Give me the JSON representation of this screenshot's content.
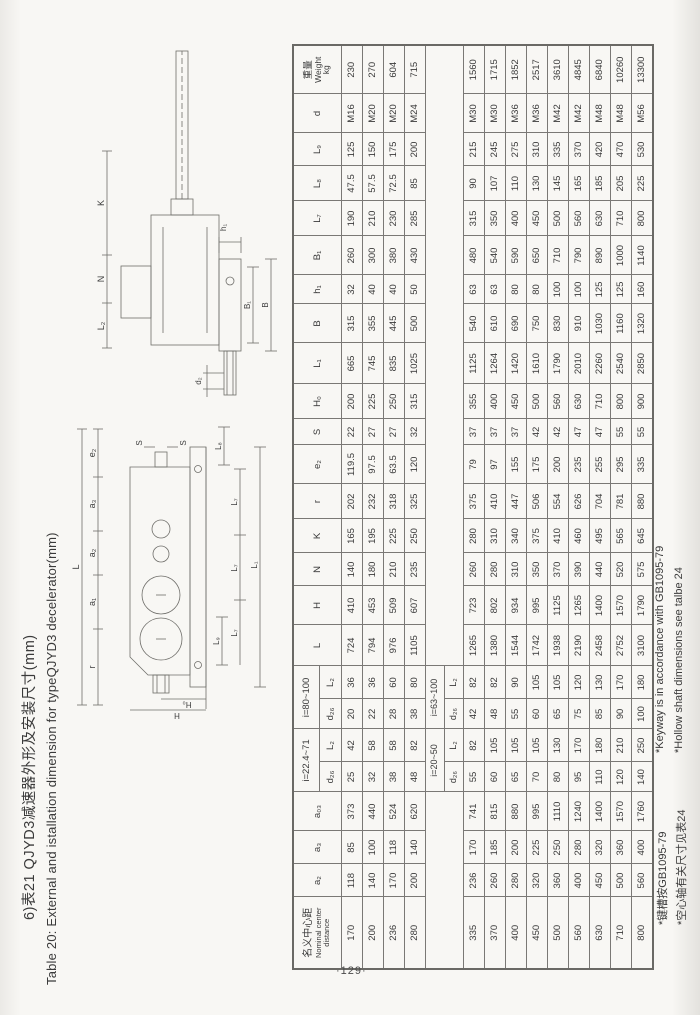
{
  "page": {
    "number": "·129·"
  },
  "title": {
    "zh": "6)表21 QJYD3减速器外形及安装尺寸(mm)",
    "en": "Table 20: External and istallation dimension for typeQJYD3 decelerator(mm)"
  },
  "diagrams": {
    "front": {
      "L": "L",
      "r": "r",
      "a1": "a₁",
      "a2": "a₂",
      "a3": "a₃",
      "e2": "e₂",
      "S1": "S",
      "S2": "S",
      "L8": "L₈",
      "H0": "H₀",
      "H": "H",
      "L9": "L₉",
      "L7": "L₇",
      "L1": "L₁"
    },
    "side": {
      "L2": "L₂",
      "N": "N",
      "K": "K",
      "h1": "h₁",
      "B1": "B₁",
      "B": "B",
      "d2": "d₂"
    }
  },
  "table": {
    "h": {
      "cd_zh": "名义中心距",
      "cd_en1": "Nominal center",
      "cd_en2": "distance",
      "a2": "a₂",
      "a3": "a₃",
      "a03": "a₀₃",
      "g1": "i=22.4~71",
      "g2": "i=80~100",
      "d26": "d₂₆",
      "L2": "L₂",
      "L": "L",
      "H": "H",
      "N": "N",
      "K": "K",
      "r": "r",
      "e2": "e₂",
      "S": "S",
      "H0": "H₀",
      "L1": "L₁",
      "B": "B",
      "h1": "h₁",
      "B1": "B₁",
      "L7": "L₇",
      "L8": "L₈",
      "L9": "L₉",
      "d": "d",
      "wt_zh": "重量",
      "wt_en": "Weight",
      "wt_unit": "kg",
      "mg1": "i=20~50",
      "mg2": "i=63~100"
    },
    "rows_block1": [
      [
        "170",
        "118",
        "85",
        "373",
        "25",
        "42",
        "20",
        "36",
        "724",
        "410",
        "140",
        "165",
        "202",
        "119.5",
        "22",
        "200",
        "665",
        "315",
        "32",
        "260",
        "190",
        "47.5",
        "125",
        "M16",
        "230"
      ],
      [
        "200",
        "140",
        "100",
        "440",
        "32",
        "58",
        "22",
        "36",
        "794",
        "453",
        "180",
        "195",
        "232",
        "97.5",
        "27",
        "225",
        "745",
        "355",
        "40",
        "300",
        "210",
        "57.5",
        "150",
        "M20",
        "270"
      ],
      [
        "236",
        "170",
        "118",
        "524",
        "38",
        "58",
        "28",
        "60",
        "976",
        "509",
        "210",
        "225",
        "318",
        "63.5",
        "27",
        "250",
        "835",
        "445",
        "40",
        "380",
        "230",
        "72.5",
        "175",
        "M20",
        "604"
      ],
      [
        "280",
        "200",
        "140",
        "620",
        "48",
        "82",
        "38",
        "80",
        "1105",
        "607",
        "235",
        "250",
        "325",
        "120",
        "32",
        "315",
        "1025",
        "500",
        "50",
        "430",
        "285",
        "85",
        "200",
        "M24",
        "715"
      ]
    ],
    "rows_block2": [
      [
        "335",
        "236",
        "170",
        "741",
        "55",
        "82",
        "42",
        "82",
        "1265",
        "723",
        "260",
        "280",
        "375",
        "79",
        "37",
        "355",
        "1125",
        "540",
        "63",
        "480",
        "315",
        "90",
        "215",
        "M30",
        "1560"
      ],
      [
        "370",
        "260",
        "185",
        "815",
        "60",
        "105",
        "48",
        "82",
        "1380",
        "802",
        "280",
        "310",
        "410",
        "97",
        "37",
        "400",
        "1264",
        "610",
        "63",
        "540",
        "350",
        "107",
        "245",
        "M30",
        "1715"
      ],
      [
        "400",
        "280",
        "200",
        "880",
        "65",
        "105",
        "55",
        "90",
        "1544",
        "934",
        "310",
        "340",
        "447",
        "155",
        "37",
        "450",
        "1420",
        "690",
        "80",
        "590",
        "400",
        "110",
        "275",
        "M36",
        "1852"
      ],
      [
        "450",
        "320",
        "225",
        "995",
        "70",
        "105",
        "60",
        "105",
        "1742",
        "995",
        "350",
        "375",
        "506",
        "175",
        "42",
        "500",
        "1610",
        "750",
        "80",
        "650",
        "450",
        "130",
        "310",
        "M36",
        "2517"
      ],
      [
        "500",
        "360",
        "250",
        "1110",
        "80",
        "130",
        "65",
        "105",
        "1938",
        "1125",
        "370",
        "410",
        "554",
        "200",
        "42",
        "560",
        "1790",
        "830",
        "100",
        "710",
        "500",
        "145",
        "335",
        "M42",
        "3610"
      ],
      [
        "560",
        "400",
        "280",
        "1240",
        "95",
        "170",
        "75",
        "120",
        "2190",
        "1265",
        "390",
        "460",
        "626",
        "235",
        "47",
        "630",
        "2010",
        "910",
        "100",
        "790",
        "560",
        "165",
        "370",
        "M42",
        "4845"
      ],
      [
        "630",
        "450",
        "320",
        "1400",
        "110",
        "180",
        "85",
        "130",
        "2458",
        "1400",
        "440",
        "495",
        "704",
        "255",
        "47",
        "710",
        "2260",
        "1030",
        "125",
        "890",
        "630",
        "185",
        "420",
        "M48",
        "6840"
      ],
      [
        "710",
        "500",
        "360",
        "1570",
        "120",
        "210",
        "90",
        "170",
        "2752",
        "1570",
        "520",
        "565",
        "781",
        "295",
        "55",
        "800",
        "2540",
        "1160",
        "125",
        "1000",
        "710",
        "205",
        "470",
        "M48",
        "10260"
      ],
      [
        "800",
        "560",
        "400",
        "1760",
        "140",
        "250",
        "100",
        "180",
        "3100",
        "1790",
        "575",
        "645",
        "880",
        "335",
        "55",
        "900",
        "2850",
        "1320",
        "160",
        "1140",
        "800",
        "225",
        "530",
        "M56",
        "13300"
      ]
    ]
  },
  "footnotes": [
    {
      "zh": "*键槽按GB1095-79",
      "en": "*Keyway is in accordance with GB1095-79"
    },
    {
      "zh": "*空心轴有关尺寸见表24",
      "en": "*Hollow shaft dimensions see talbe 24"
    }
  ]
}
